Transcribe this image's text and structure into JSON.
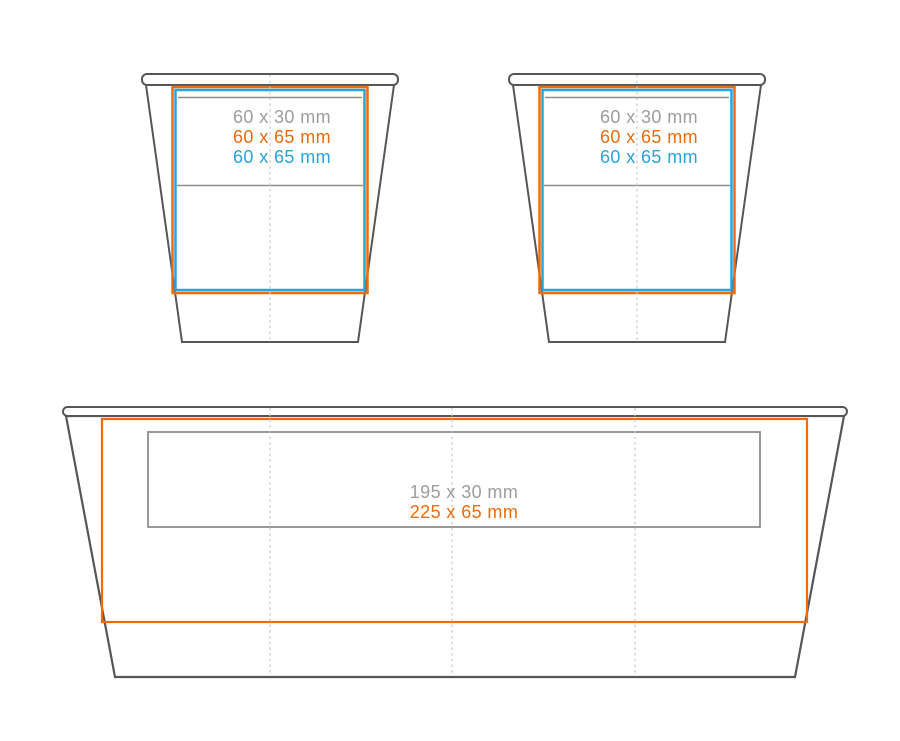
{
  "colors": {
    "outline": "#55565A",
    "orange": "#ED6B0C",
    "blue": "#29A3DC",
    "gray_text": "#9D9D9C",
    "gray_line": "#8E8E8E",
    "dash_line": "#C8C8C8",
    "background": "#FFFFFF"
  },
  "figures": {
    "cup_left": {
      "labels": [
        {
          "text": "60 x 30 mm",
          "color": "#9D9D9C"
        },
        {
          "text": "60 x 65 mm",
          "color": "#ED6B0C"
        },
        {
          "text": "60 x 65 mm",
          "color": "#29A3DC"
        }
      ]
    },
    "cup_right": {
      "labels": [
        {
          "text": "60 x 30 mm",
          "color": "#9D9D9C"
        },
        {
          "text": "60 x 65 mm",
          "color": "#ED6B0C"
        },
        {
          "text": "60 x 65 mm",
          "color": "#29A3DC"
        }
      ]
    },
    "wrap": {
      "labels": [
        {
          "text": "195 x 30 mm",
          "color": "#9D9D9C"
        },
        {
          "text": "225 x 65 mm",
          "color": "#ED6B0C"
        }
      ]
    }
  }
}
